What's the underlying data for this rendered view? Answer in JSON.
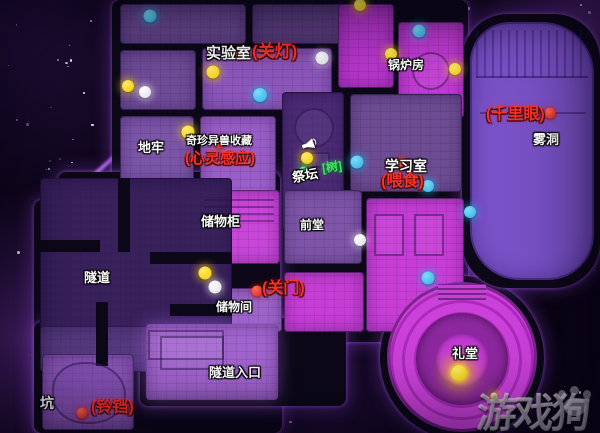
{
  "page": {
    "type": "game-map-screenshot",
    "watermark": "游戏狗"
  },
  "colors": {
    "wall": "#0c0818",
    "magenta_room": "#c73dd6",
    "purple_room": "#8d57bc",
    "muted_room": "#6d4c93",
    "dark_tunnel": "#39215c",
    "cave_room": "#7a52c8",
    "label_red": "#ff3226",
    "dot_yellow": "#f2cc00",
    "dot_cyan": "#29b2e6",
    "dot_white": "#ffffff",
    "dot_red": "#e31f12",
    "dot_green": "#27d24d"
  },
  "rooms": [
    {
      "id": "lab",
      "name": "实验室"
    },
    {
      "id": "boiler",
      "name": "锅炉房"
    },
    {
      "id": "cloud-cave",
      "name": "雾洞"
    },
    {
      "id": "dungeon",
      "name": "地牢"
    },
    {
      "id": "collection",
      "name": "奇珍异兽收藏"
    },
    {
      "id": "altar",
      "name": "祭坛"
    },
    {
      "id": "study",
      "name": "学习室"
    },
    {
      "id": "locker",
      "name": "储物柜"
    },
    {
      "id": "front-hall",
      "name": "前堂"
    },
    {
      "id": "tunnel",
      "name": "隧道"
    },
    {
      "id": "storage",
      "name": "储物间"
    },
    {
      "id": "tunnel-entrance",
      "name": "隧道入口"
    },
    {
      "id": "auditorium",
      "name": "礼堂"
    },
    {
      "id": "pit",
      "name": "坑"
    }
  ],
  "labels": [
    {
      "id": "lab",
      "text": "实验室",
      "style": "white",
      "x": 206,
      "y": 46,
      "size": 15
    },
    {
      "id": "lab-skill",
      "text": "(关灯)",
      "style": "red",
      "x": 252,
      "y": 43,
      "size": 17
    },
    {
      "id": "boiler",
      "text": "锅炉房",
      "style": "white",
      "x": 388,
      "y": 59,
      "size": 12
    },
    {
      "id": "clairvoyance",
      "text": "(千里眼)",
      "style": "red",
      "x": 486,
      "y": 107,
      "size": 16
    },
    {
      "id": "cave",
      "text": "雾洞",
      "style": "white",
      "x": 533,
      "y": 133,
      "size": 13
    },
    {
      "id": "dungeon",
      "text": "地牢",
      "style": "white",
      "x": 138,
      "y": 141,
      "size": 13
    },
    {
      "id": "collection",
      "text": "奇珍异兽收藏",
      "style": "white",
      "x": 186,
      "y": 136,
      "size": 11
    },
    {
      "id": "telepathy",
      "text": "(心灵感应)",
      "style": "red",
      "x": 185,
      "y": 151,
      "size": 15
    },
    {
      "id": "altar",
      "text": "祭坛",
      "style": "white",
      "x": 292,
      "y": 169,
      "size": 13,
      "rot": -10
    },
    {
      "id": "altar-tag",
      "text": "[树]",
      "style": "green",
      "x": 322,
      "y": 161,
      "size": 12,
      "rot": -8
    },
    {
      "id": "study",
      "text": "学习室",
      "style": "white",
      "x": 385,
      "y": 159,
      "size": 14
    },
    {
      "id": "study-skill",
      "text": "(喂食)",
      "style": "red",
      "x": 381,
      "y": 174,
      "size": 16
    },
    {
      "id": "locker",
      "text": "储物柜",
      "style": "white",
      "x": 201,
      "y": 215,
      "size": 13
    },
    {
      "id": "front-hall",
      "text": "前堂",
      "style": "white",
      "x": 300,
      "y": 219,
      "size": 12
    },
    {
      "id": "tunnel",
      "text": "隧道",
      "style": "white",
      "x": 84,
      "y": 271,
      "size": 13
    },
    {
      "id": "door-skill",
      "text": "(关门)",
      "style": "red",
      "x": 262,
      "y": 281,
      "size": 16
    },
    {
      "id": "storage",
      "text": "储物间",
      "style": "white",
      "x": 216,
      "y": 301,
      "size": 12
    },
    {
      "id": "entrance",
      "text": "隧道入口",
      "style": "white",
      "x": 209,
      "y": 366,
      "size": 13
    },
    {
      "id": "auditorium",
      "text": "礼堂",
      "style": "white",
      "x": 452,
      "y": 347,
      "size": 13
    },
    {
      "id": "pit",
      "text": "坑",
      "style": "white",
      "x": 40,
      "y": 396,
      "size": 14
    },
    {
      "id": "bell-skill",
      "text": "(铃铛)",
      "style": "red",
      "x": 91,
      "y": 400,
      "size": 16
    }
  ],
  "dots": [
    {
      "c": "cyan",
      "x": 150,
      "y": 16,
      "d": 13
    },
    {
      "c": "cyan",
      "x": 419,
      "y": 31,
      "d": 13
    },
    {
      "c": "cyan",
      "x": 260,
      "y": 95,
      "d": 14
    },
    {
      "c": "cyan",
      "x": 357,
      "y": 162,
      "d": 13
    },
    {
      "c": "cyan",
      "x": 428,
      "y": 186,
      "d": 12
    },
    {
      "c": "cyan",
      "x": 470,
      "y": 212,
      "d": 12
    },
    {
      "c": "cyan",
      "x": 428,
      "y": 278,
      "d": 13
    },
    {
      "c": "yellow",
      "x": 360,
      "y": 5,
      "d": 12
    },
    {
      "c": "yellow",
      "x": 391,
      "y": 54,
      "d": 12
    },
    {
      "c": "yellow",
      "x": 455,
      "y": 69,
      "d": 12
    },
    {
      "c": "yellow",
      "x": 213,
      "y": 72,
      "d": 13
    },
    {
      "c": "yellow",
      "x": 128,
      "y": 86,
      "d": 12
    },
    {
      "c": "yellow",
      "x": 188,
      "y": 132,
      "d": 13
    },
    {
      "c": "yellow",
      "x": 307,
      "y": 158,
      "d": 12
    },
    {
      "c": "yellow",
      "x": 205,
      "y": 273,
      "d": 13
    },
    {
      "c": "yellow",
      "x": 459,
      "y": 373,
      "d": 16,
      "big": true
    },
    {
      "c": "yellow",
      "x": 494,
      "y": 396,
      "d": 7
    },
    {
      "c": "white",
      "x": 322,
      "y": 58,
      "d": 13
    },
    {
      "c": "white",
      "x": 145,
      "y": 92,
      "d": 12
    },
    {
      "c": "white",
      "x": 360,
      "y": 240,
      "d": 12
    },
    {
      "c": "white",
      "x": 215,
      "y": 287,
      "d": 13
    },
    {
      "c": "red",
      "x": 240,
      "y": 53,
      "d": 11
    },
    {
      "c": "red",
      "x": 220,
      "y": 143,
      "d": 11
    },
    {
      "c": "red",
      "x": 403,
      "y": 163,
      "d": 11
    },
    {
      "c": "red",
      "x": 550,
      "y": 113,
      "d": 11
    },
    {
      "c": "red",
      "x": 257,
      "y": 291,
      "d": 11
    },
    {
      "c": "red",
      "x": 82,
      "y": 413,
      "d": 11
    },
    {
      "c": "green",
      "x": 304,
      "y": 172,
      "d": 11
    }
  ],
  "icons": [
    {
      "id": "speaker-icon",
      "x": 302,
      "y": 139
    }
  ]
}
